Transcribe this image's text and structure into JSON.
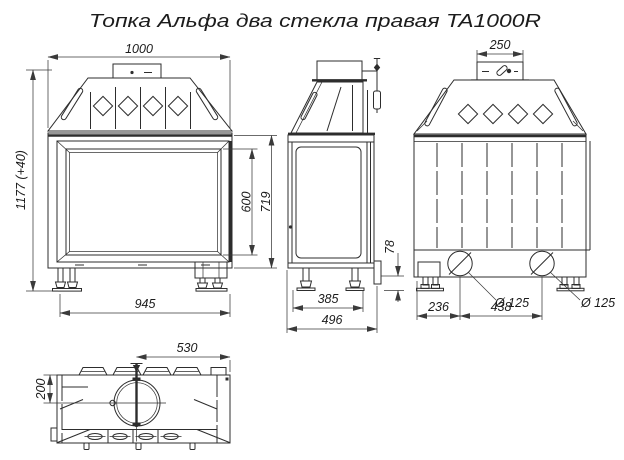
{
  "title": "Топка Альфа два стекла правая TA1000R",
  "colors": {
    "line": "#2d2d2d",
    "dimension": "#3a3a3a",
    "text": "#1c1c1c",
    "background": "#ffffff"
  },
  "front_view": {
    "dim_width_top": "1000",
    "dim_height_overall": "1177 (+40)",
    "dim_glass_height": "600",
    "dim_firebox_height": "719",
    "dim_width_bottom": "945"
  },
  "side_view": {
    "dim_depth_feet": "385",
    "dim_depth_overall": "496",
    "dim_base_gap": "78"
  },
  "rear_view": {
    "dim_flue_collar": "250",
    "dim_air_left_offset": "236",
    "dim_air_spacing": "438",
    "air_inlet_left": "Ø 125",
    "air_inlet_right": "Ø 125"
  },
  "top_view": {
    "dim_center_to_edge": "530",
    "dim_front_to_flue": "200"
  }
}
